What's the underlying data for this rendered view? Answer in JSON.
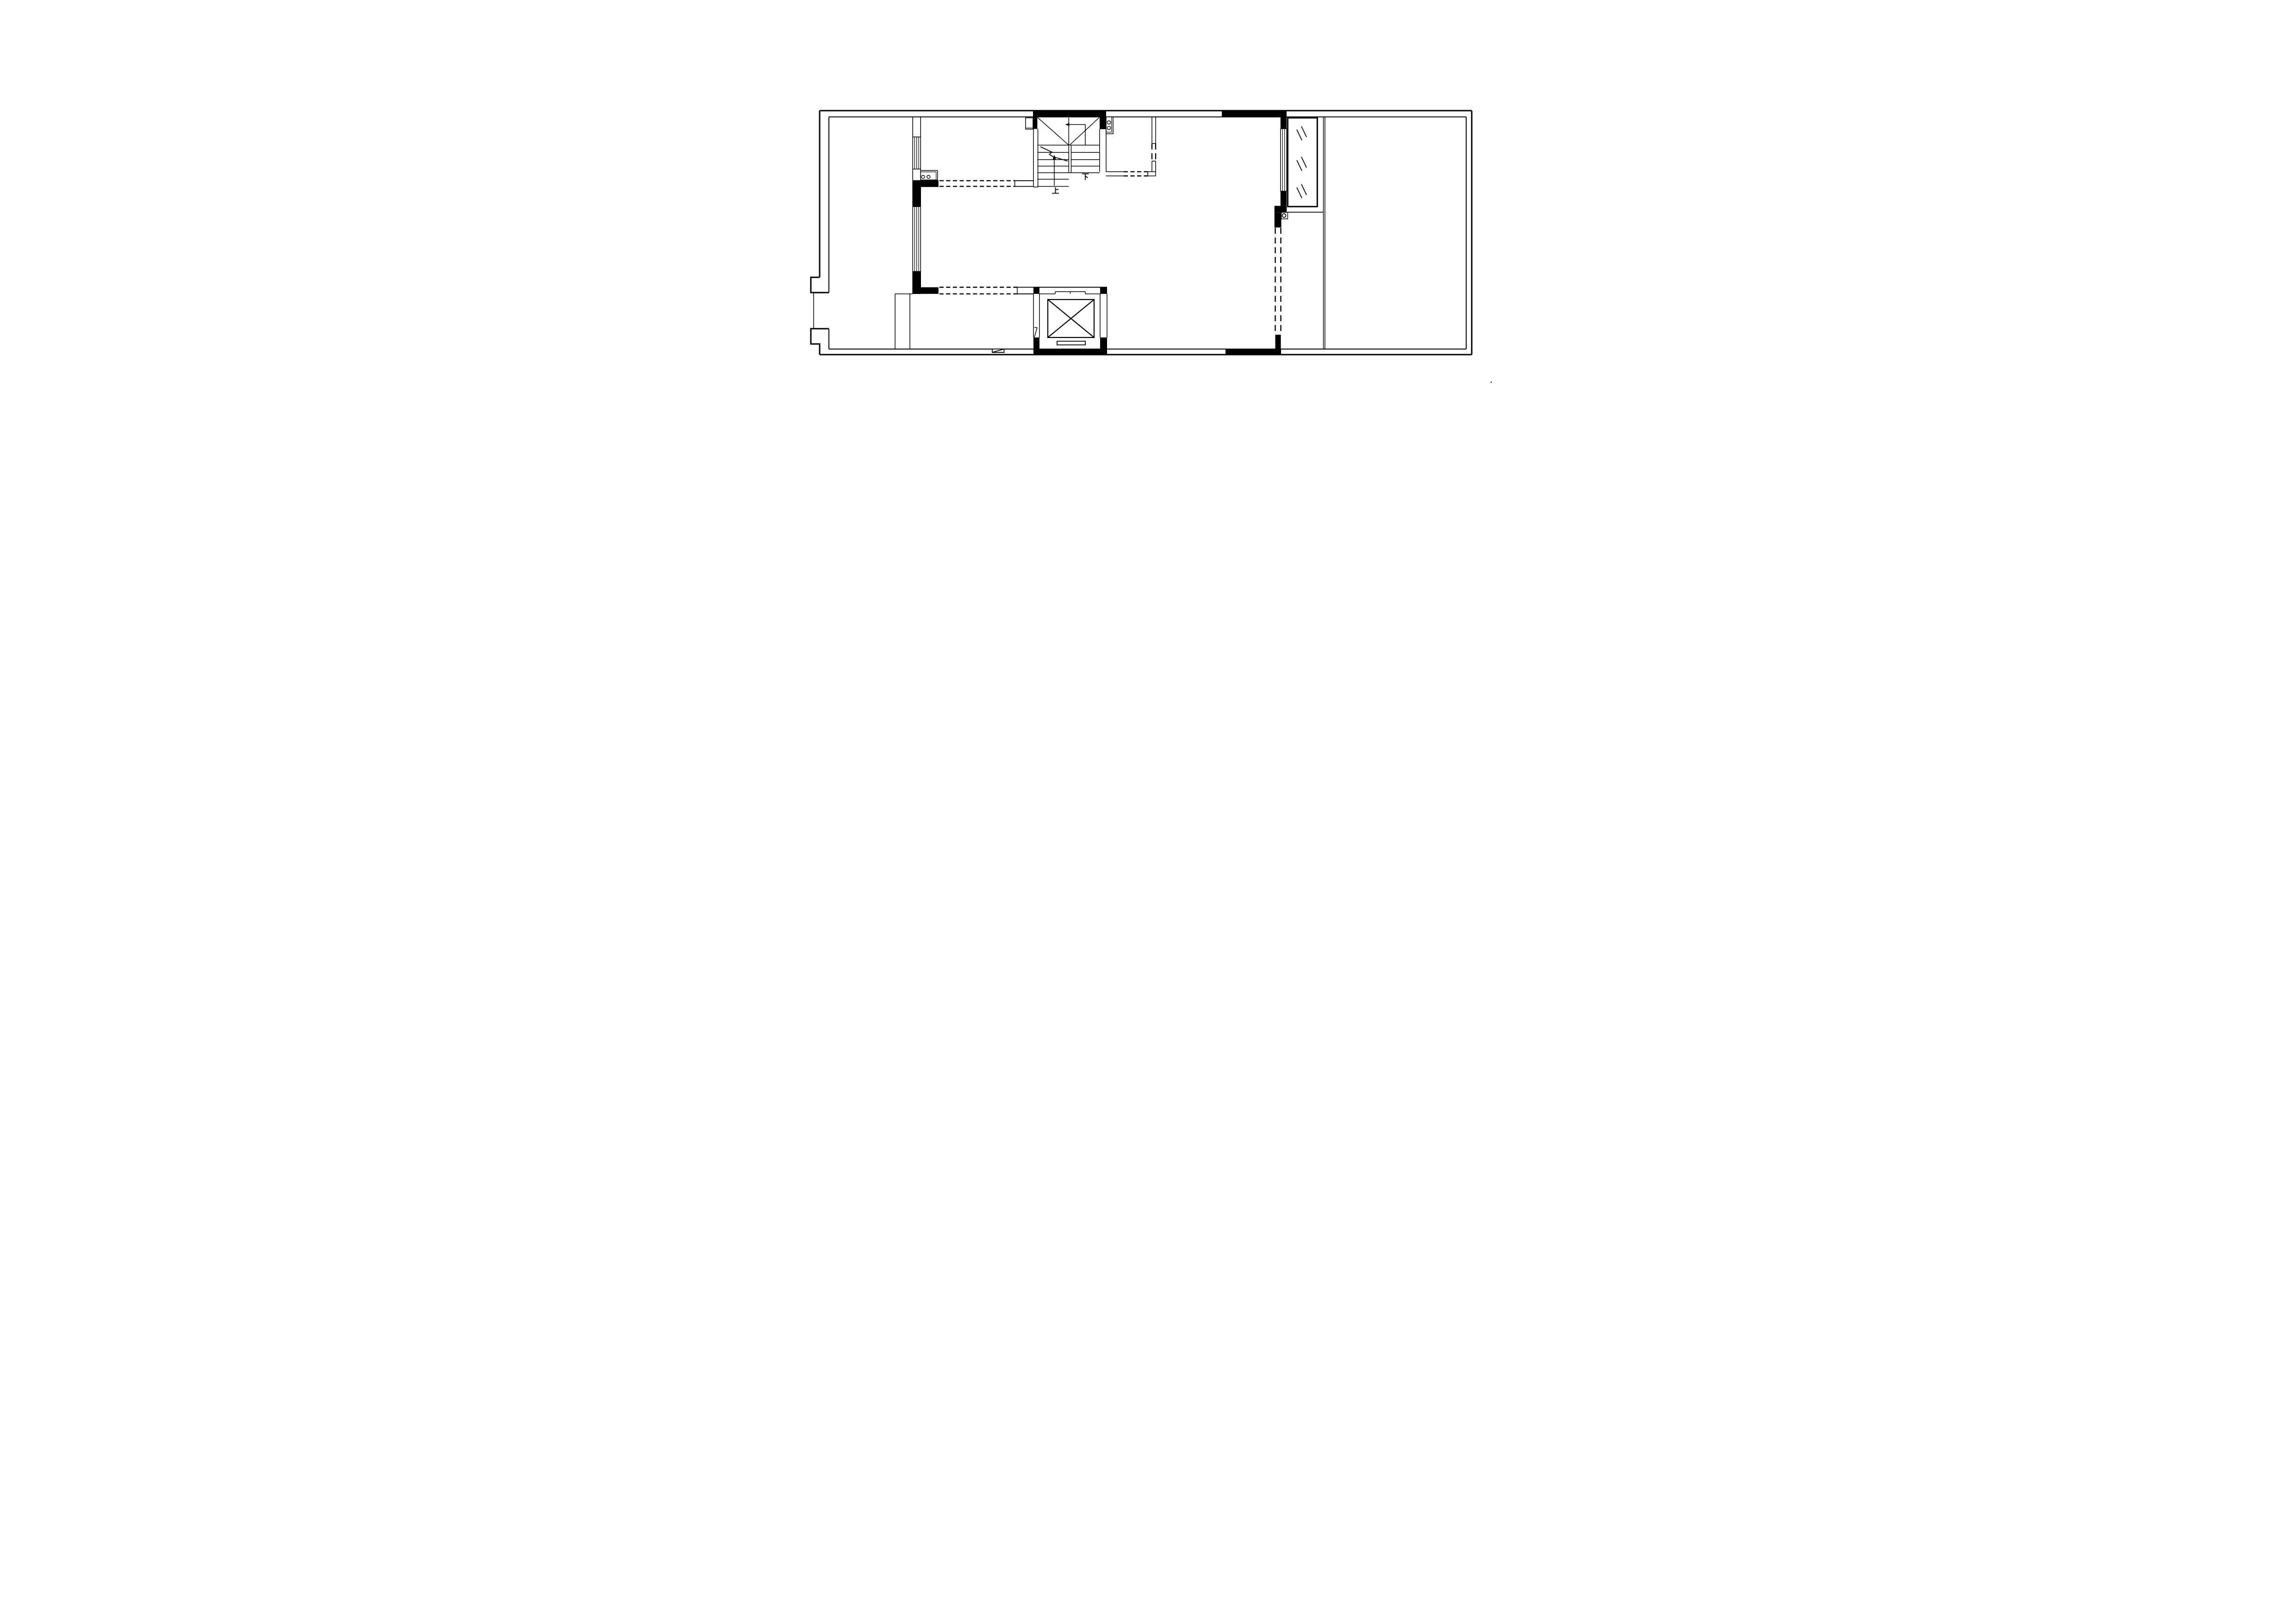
{
  "document": {
    "kind": "architectural-floor-plan",
    "style": "black and white CAD line drawing on blank sheet",
    "paper_color": "#ffffff",
    "line_color": "#000000"
  },
  "labels": {
    "stairs_up": "上",
    "stairs_down": "下"
  },
  "stairs": {
    "up_label": "上",
    "down_label": "下",
    "left_flight_tread_lines": 6,
    "right_flight_tread_lines": 4,
    "has_break_line": true,
    "has_landing_cross_lines": true
  },
  "elevator": {
    "car_symbol": "square with X cross",
    "has_door_slot": true
  },
  "fixtures": {
    "kitchen_sink": {
      "basin_circles": 2,
      "orientation": "horizontal"
    },
    "stove_unit": {
      "burner_circles": 2,
      "orientation": "vertical"
    },
    "round_column": {
      "circles": 1
    },
    "glazed_panel": {
      "glass_tick_groups": 3
    }
  },
  "windows": {
    "left_wall_window_segments": 2,
    "right_wall_window_segments": 1,
    "pane_lines_per_window": 5
  },
  "openings_dashed": {
    "horizontal_dashed_pairs": 3,
    "vertical_dashed_pairs": 2
  },
  "colors": {
    "wall_fill": "#000000",
    "background": "#ffffff"
  }
}
